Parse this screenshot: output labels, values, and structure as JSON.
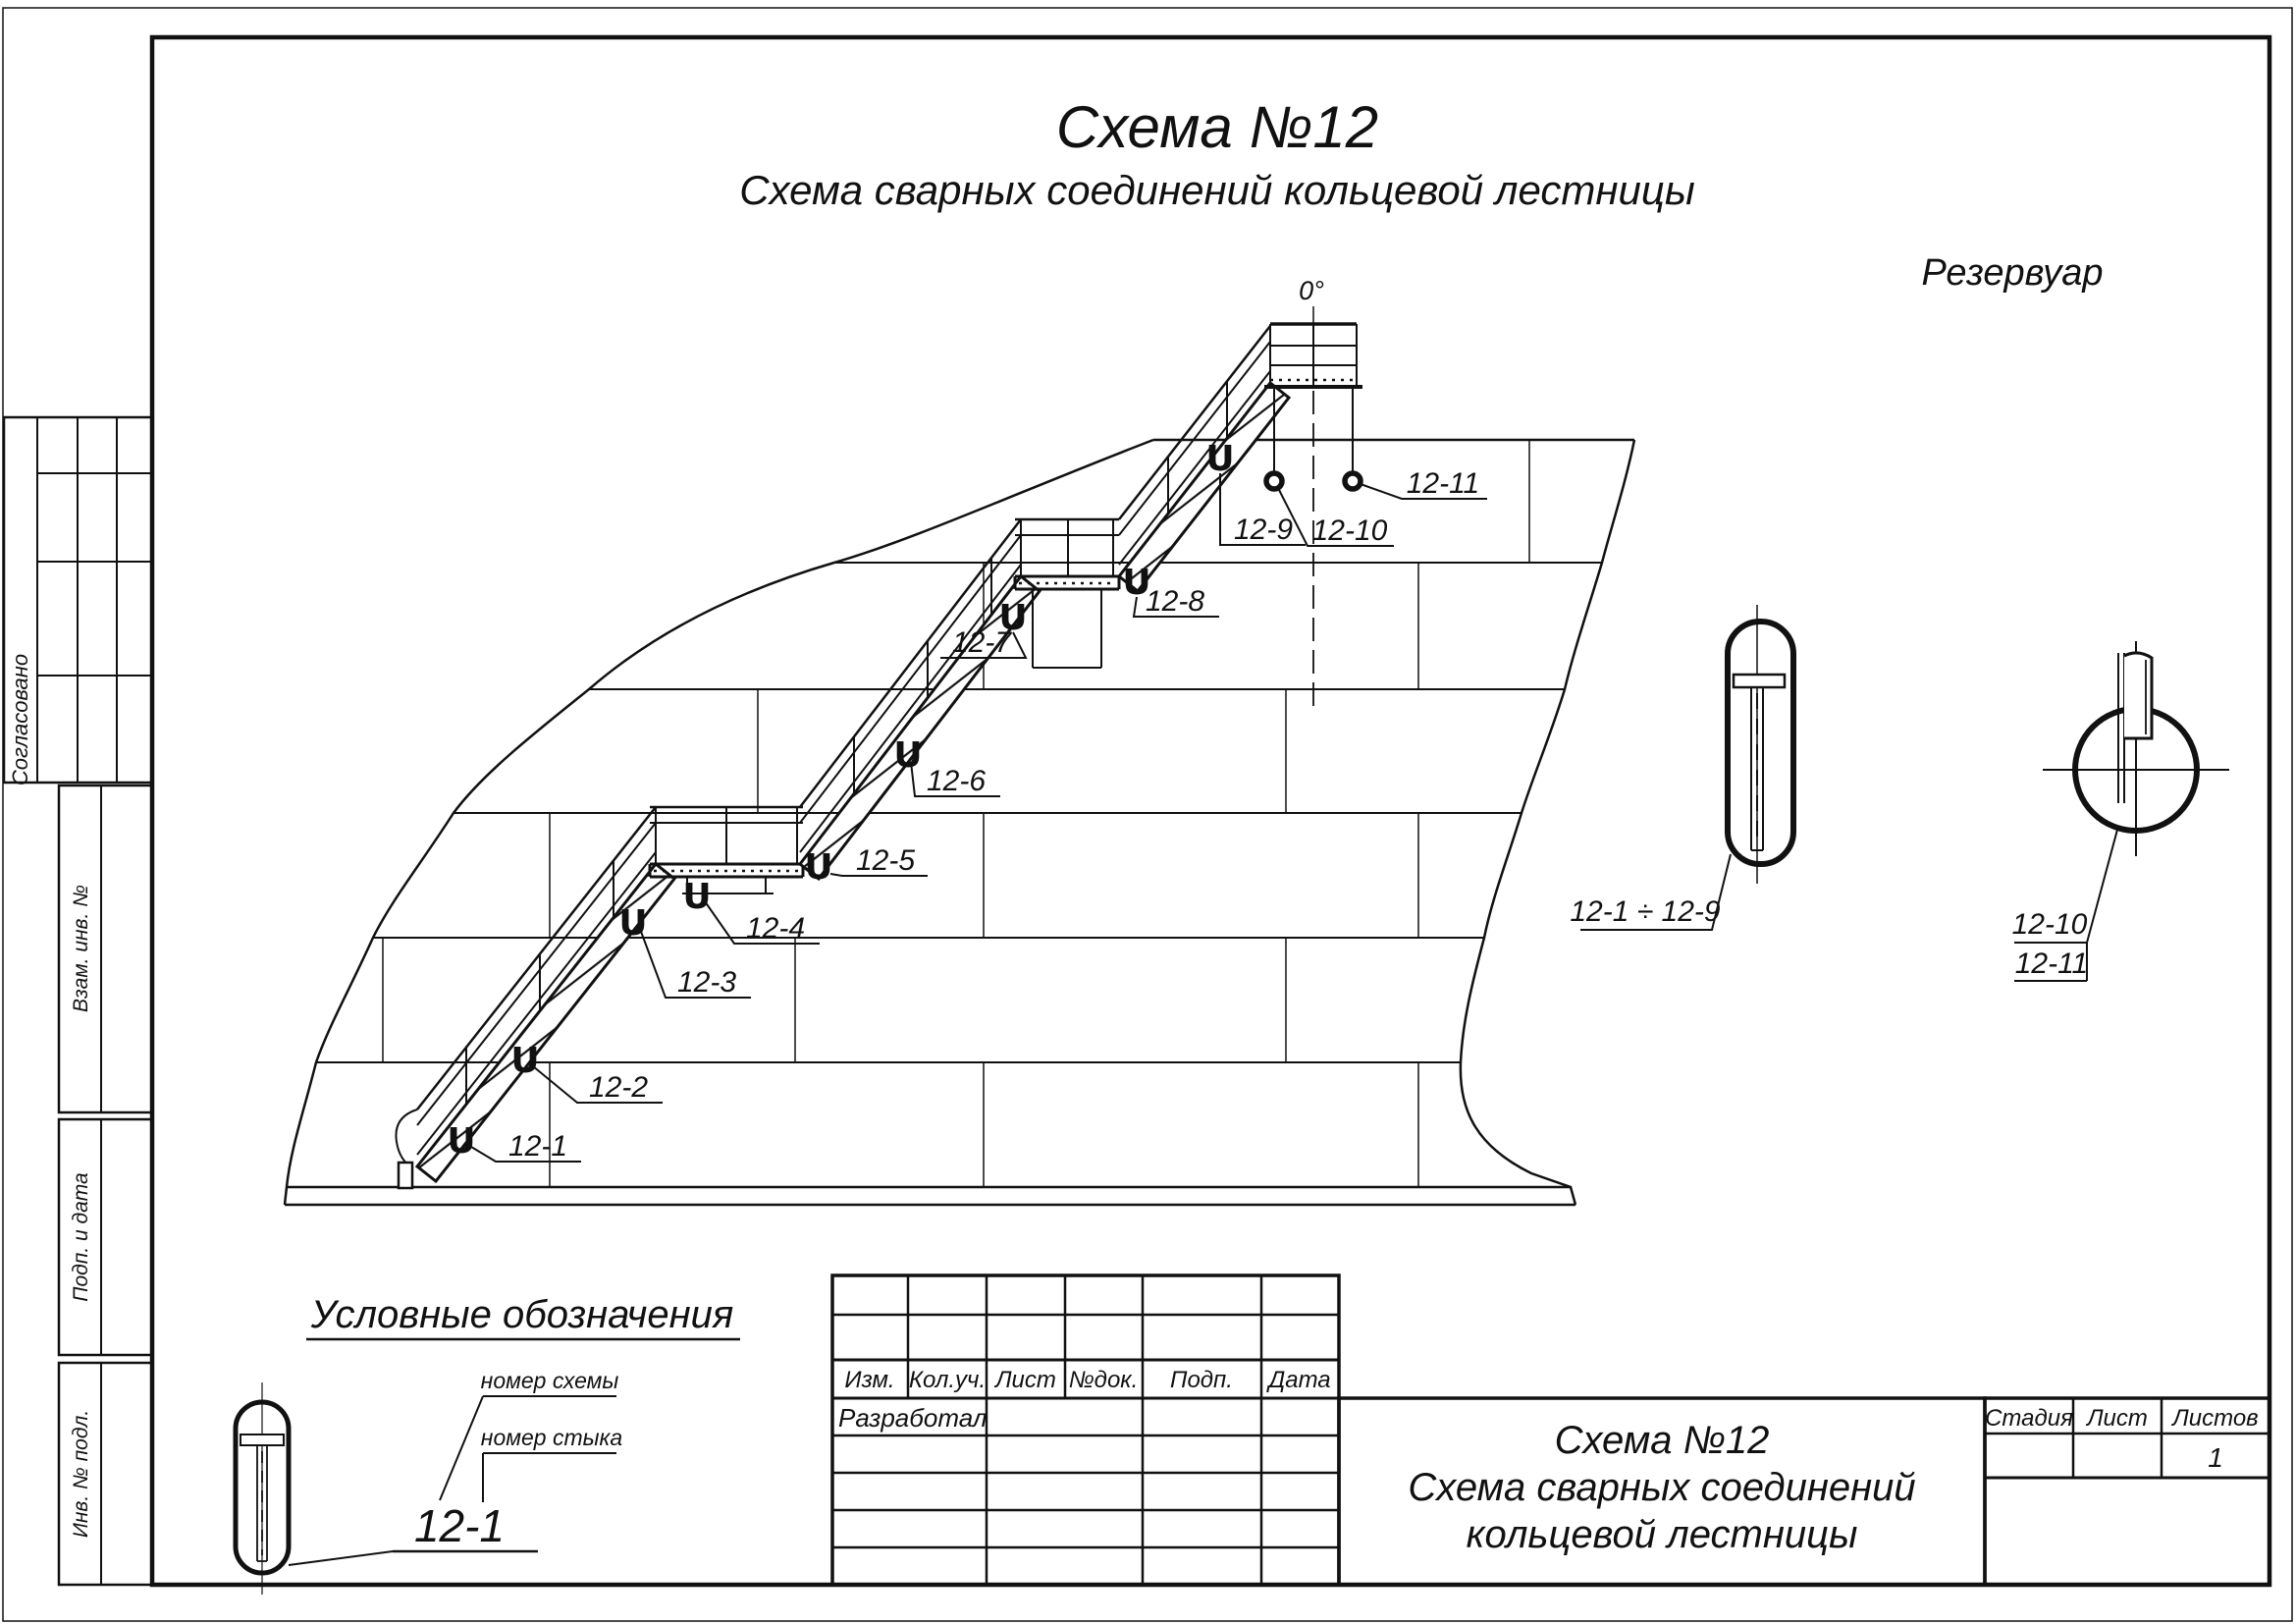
{
  "main_title": {
    "line1": "Схема №12",
    "line2": "Схема сварных соединений кольцевой лестницы"
  },
  "drawing": {
    "reservoir_label": "Резервуар",
    "angle_label": "0°",
    "weld_marker_glyph": "U",
    "joints": [
      "12-1",
      "12-2",
      "12-3",
      "12-4",
      "12-5",
      "12-6",
      "12-7",
      "12-8",
      "12-9",
      "12-10",
      "12-11"
    ],
    "detail_capsule_label": "12-1 ÷ 12-9",
    "detail_circle_labels": [
      "12-10",
      "12-11"
    ]
  },
  "legend": {
    "title": "Условные обозначения",
    "example": "12-1",
    "scheme_number_label": "номер схемы",
    "joint_number_label": "номер стыка"
  },
  "side_stamp": {
    "approved": "Согласовано",
    "vzam": "Взам. инв. №",
    "podp_data": "Подп. и дата",
    "inv_podl": "Инв. № подл."
  },
  "title_block": {
    "rev_headers": [
      "Изм.",
      "Кол.уч.",
      "Лист",
      "№док.",
      "Подп.",
      "Дата"
    ],
    "developed_by": "Разработал",
    "doc_title_lines": [
      "Схема №12",
      "Схема сварных соединений",
      "кольцевой лестницы"
    ],
    "stage_header": "Стадия",
    "sheet_header": "Лист",
    "sheets_header": "Листов",
    "sheets_value": "1"
  }
}
